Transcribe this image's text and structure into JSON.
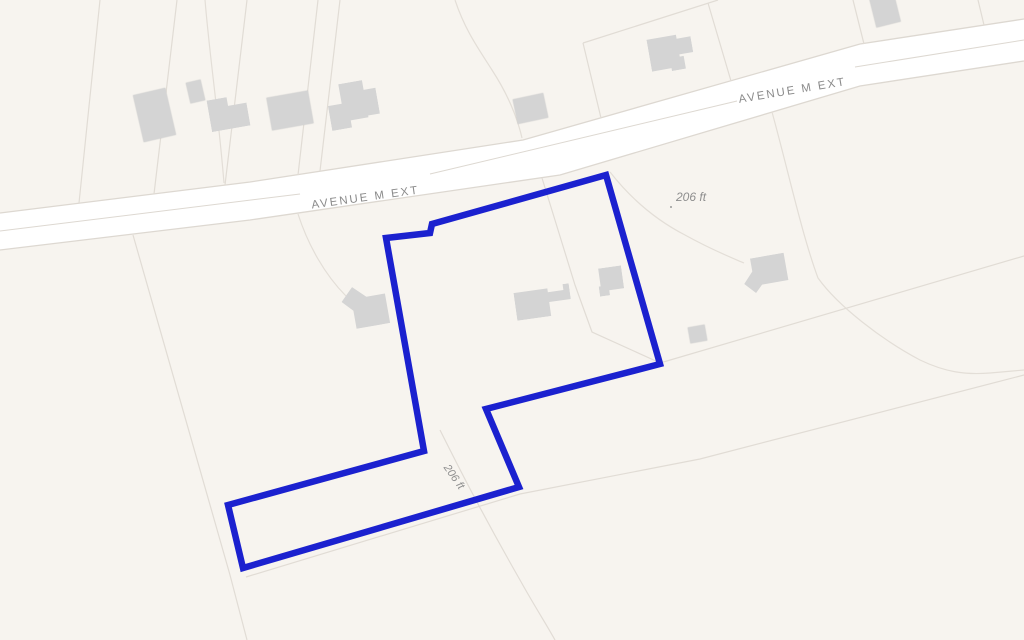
{
  "map": {
    "road_labels": [
      {
        "text": "AVENUE M EXT"
      },
      {
        "text": "AVENUE M EXT"
      }
    ],
    "dimension_labels": [
      {
        "text": "206 ft"
      },
      {
        "text": "206 ft"
      }
    ],
    "colors": {
      "background": "#f7f4ef",
      "road_fill": "#ffffff",
      "road_casing": "#ddd8d1",
      "parcel_line": "#e1dcd5",
      "driveway_line": "#e3ded7",
      "building_fill": "#d4d4d4",
      "boundary_blue": "#1b21cf",
      "label_gray": "#8a8a8a"
    }
  }
}
